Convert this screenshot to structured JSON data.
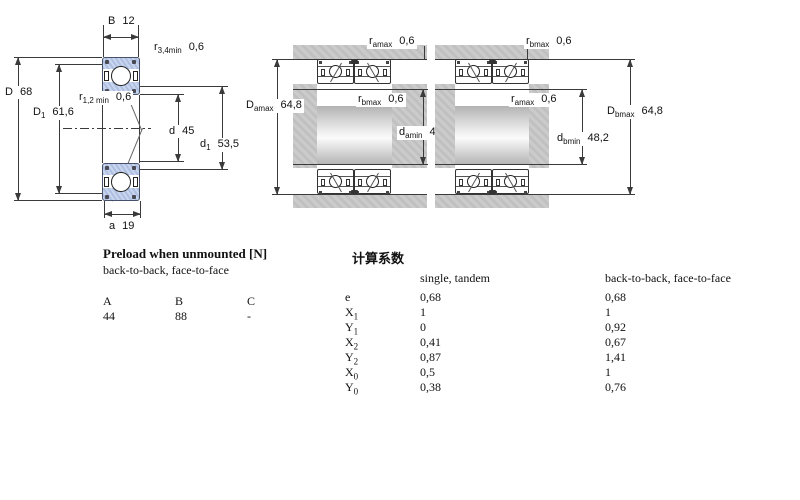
{
  "colors": {
    "ring_blue": "#b9c9e6",
    "housing_gray": "#c6c6c6",
    "line": "#3a3a3a"
  },
  "fig_single": {
    "B_name": "B",
    "B_value": "12",
    "r34_name": "r",
    "r34_sub": "3,4min",
    "r34_value": "0,6",
    "D_name": "D",
    "D_value": "68",
    "D1_name": "D",
    "D1_sub": "1",
    "D1_value": "61,6",
    "r12_name": "r",
    "r12_sub": "1,2 min",
    "r12_value": "0,6",
    "d_name": "d",
    "d_value": "45",
    "d1_name": "d",
    "d1_sub": "1",
    "d1_value": "53,5",
    "a_name": "a",
    "a_value": "19"
  },
  "fig_back_to_back": {
    "ramax_name": "r",
    "ramax_sub": "amax",
    "ramax_value": "0,6",
    "Damax_name": "D",
    "Damax_sub": "amax",
    "Damax_value": "64,8",
    "rbmax_name": "r",
    "rbmax_sub": "bmax",
    "rbmax_value": "0,6",
    "damin_name": "d",
    "damin_sub": "amin",
    "damin_value": "48,2"
  },
  "fig_face_to_face": {
    "rbmax_name": "r",
    "rbmax_sub": "bmax",
    "rbmax_value": "0,6",
    "ramax_name": "r",
    "ramax_sub": "amax",
    "ramax_value": "0,6",
    "Dbmax_name": "D",
    "Dbmax_sub": "bmax",
    "Dbmax_value": "64,8",
    "dbmin_name": "d",
    "dbmin_sub": "bmin",
    "dbmin_value": "48,2"
  },
  "preload_table": {
    "title": "Preload when unmounted [N]",
    "subtitle": "back-to-back, face-to-face",
    "columns": [
      "A",
      "B",
      "C"
    ],
    "values": [
      "44",
      "88",
      "-"
    ]
  },
  "factors_table": {
    "title": "计算系数",
    "col1_header": "single, tandem",
    "col2_header": "back-to-back, face-to-face",
    "rows": [
      {
        "label": "e",
        "sub": "",
        "single": "0,68",
        "b2b": "0,68"
      },
      {
        "label": "X",
        "sub": "1",
        "single": "1",
        "b2b": "1"
      },
      {
        "label": "Y",
        "sub": "1",
        "single": "0",
        "b2b": "0,92"
      },
      {
        "label": "X",
        "sub": "2",
        "single": "0,41",
        "b2b": "0,67"
      },
      {
        "label": "Y",
        "sub": "2",
        "single": "0,87",
        "b2b": "1,41"
      },
      {
        "label": "X",
        "sub": "0",
        "single": "0,5",
        "b2b": "1"
      },
      {
        "label": "Y",
        "sub": "0",
        "single": "0,38",
        "b2b": "0,76"
      }
    ]
  }
}
